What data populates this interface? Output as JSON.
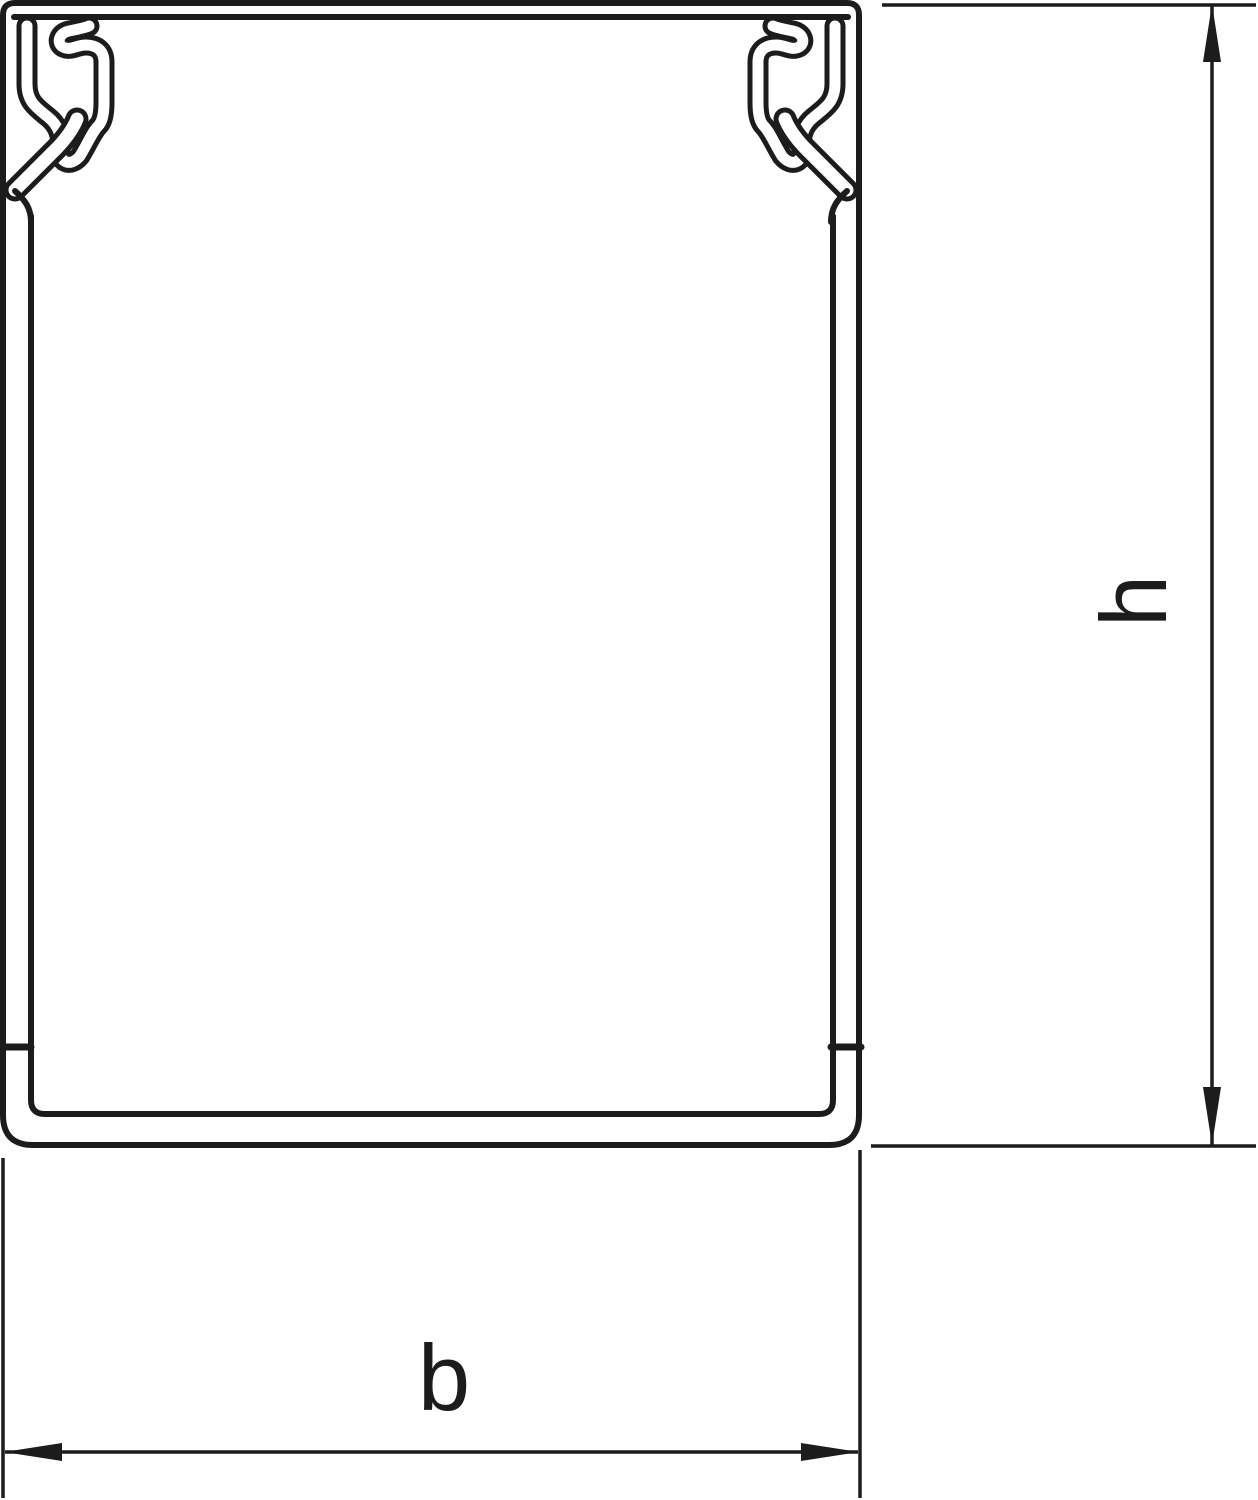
{
  "diagram": {
    "kind": "technical cross-section line drawing",
    "labels": {
      "height_dimension": "h",
      "width_dimension": "b"
    },
    "colors": {
      "line": "#1c1c1c",
      "background": "#ffffff"
    },
    "icons": {
      "height_dimension_arrows": [
        "arrow-up-icon",
        "arrow-down-icon"
      ],
      "width_dimension_arrows": [
        "arrow-left-icon",
        "arrow-right-icon"
      ]
    }
  }
}
